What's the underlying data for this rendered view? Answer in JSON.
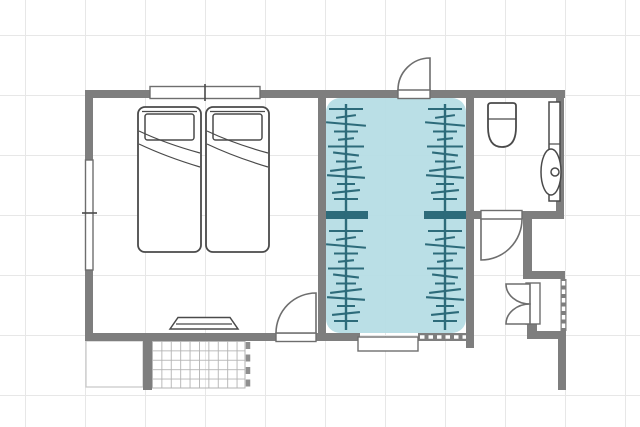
{
  "colors": {
    "background": "#ffffff",
    "grid_line": "#e7e7e7",
    "wall": "#7e7e7e",
    "outline_dark": "#4a4a4a",
    "outline_mid": "#6e6e6e",
    "closet_fill": "#b5dde4",
    "closet_accent": "#2d6b7a",
    "tile_line": "#b3b3b3",
    "dash_mark": "#8f8f8f",
    "step_line": "#c6c6c6"
  },
  "rooms": [
    {
      "name": "bedroom",
      "furniture": [
        "twin bed",
        "twin bed",
        "wall shelf"
      ],
      "openings": [
        "window top wall",
        "window left wall",
        "swing door bottom wall"
      ]
    },
    {
      "name": "walk-in-closet",
      "highlighted": true,
      "features": [
        "clothes rail with hangers x2",
        "divider stubs",
        "sliding window bottom",
        "swing door top"
      ]
    },
    {
      "name": "bathroom",
      "furniture": [
        "toilet",
        "vanity counter with oval sink"
      ],
      "openings": [
        "swing door to hallway"
      ]
    },
    {
      "name": "hallway",
      "features": [
        "storage closet with bi-fold door",
        "shelf dashes"
      ]
    },
    {
      "name": "patio",
      "features": [
        "tiled floor",
        "step outline",
        "dashed boundary"
      ]
    }
  ],
  "closet": {
    "rods": [
      346,
      445
    ],
    "rail_y": [
      104,
      330
    ],
    "sections": [
      [
        109,
        204
      ],
      [
        231,
        326
      ]
    ],
    "tick_step": 7.5,
    "tick_widths": [
      34,
      20,
      40,
      24,
      16,
      36,
      26,
      20,
      32,
      38,
      18,
      28,
      24
    ],
    "tick_angles": [
      0,
      -8,
      5,
      0,
      -6,
      0,
      7,
      0,
      -7,
      4,
      0,
      -6,
      0
    ]
  }
}
